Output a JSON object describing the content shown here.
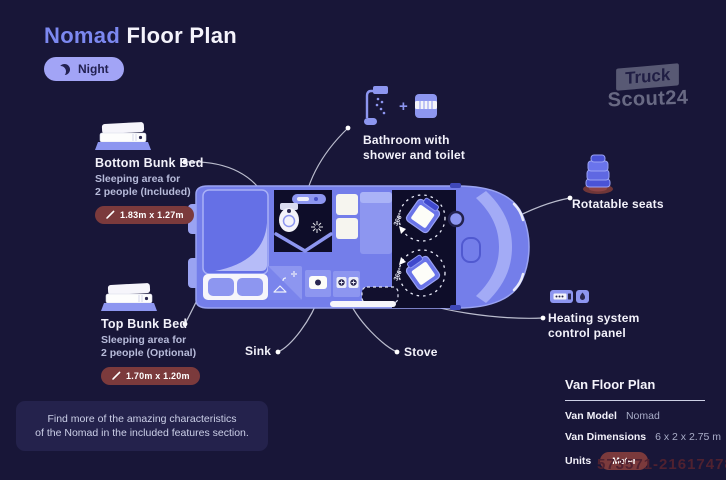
{
  "header": {
    "title_accent": "Nomad",
    "title_rest": "Floor Plan",
    "mode_label": "Night"
  },
  "watermark": {
    "logo_line1": "Truck",
    "logo_line2": "Scout24",
    "number": "573571-21617478"
  },
  "annotations": {
    "bottom_bunk": {
      "title": "Bottom Bunk Bed",
      "desc_line1": "Sleeping area for",
      "desc_line2": "2 people (Included)",
      "badge": "1.83m x 1.27m"
    },
    "top_bunk": {
      "title": "Top Bunk Bed",
      "desc_line1": "Sleeping area for",
      "desc_line2": "2 people (Optional)",
      "badge": "1.70m x 1.20m"
    },
    "bathroom": {
      "plus": "+",
      "label_line1": "Bathroom with",
      "label_line2": "shower and toilet"
    },
    "rotatable_seats": {
      "label": "Rotatable seats"
    },
    "heating": {
      "label_line1": "Heating system",
      "label_line2": "control panel"
    },
    "sink": {
      "label": "Sink"
    },
    "stove": {
      "label": "Stove"
    }
  },
  "floor_plan": {
    "rotation_label": "360°"
  },
  "info_panel": {
    "title": "Van Floor Plan",
    "rows": [
      {
        "label": "Van Model",
        "value": "Nomad"
      },
      {
        "label": "Van Dimensions",
        "value": "6 x 2 x 2.75 m"
      },
      {
        "label": "Units",
        "value": "Meter"
      }
    ]
  },
  "note": {
    "line1": "Find more of the amazing characteristics",
    "line2": "of the Nomad in the included features section."
  },
  "colors": {
    "background": "#181638",
    "accent": "#7c88f0",
    "van_body": "#747eea",
    "badge": "#7b3a3c",
    "night_pill": "#a2a4f6",
    "dark_interior": "#0e0d29"
  }
}
